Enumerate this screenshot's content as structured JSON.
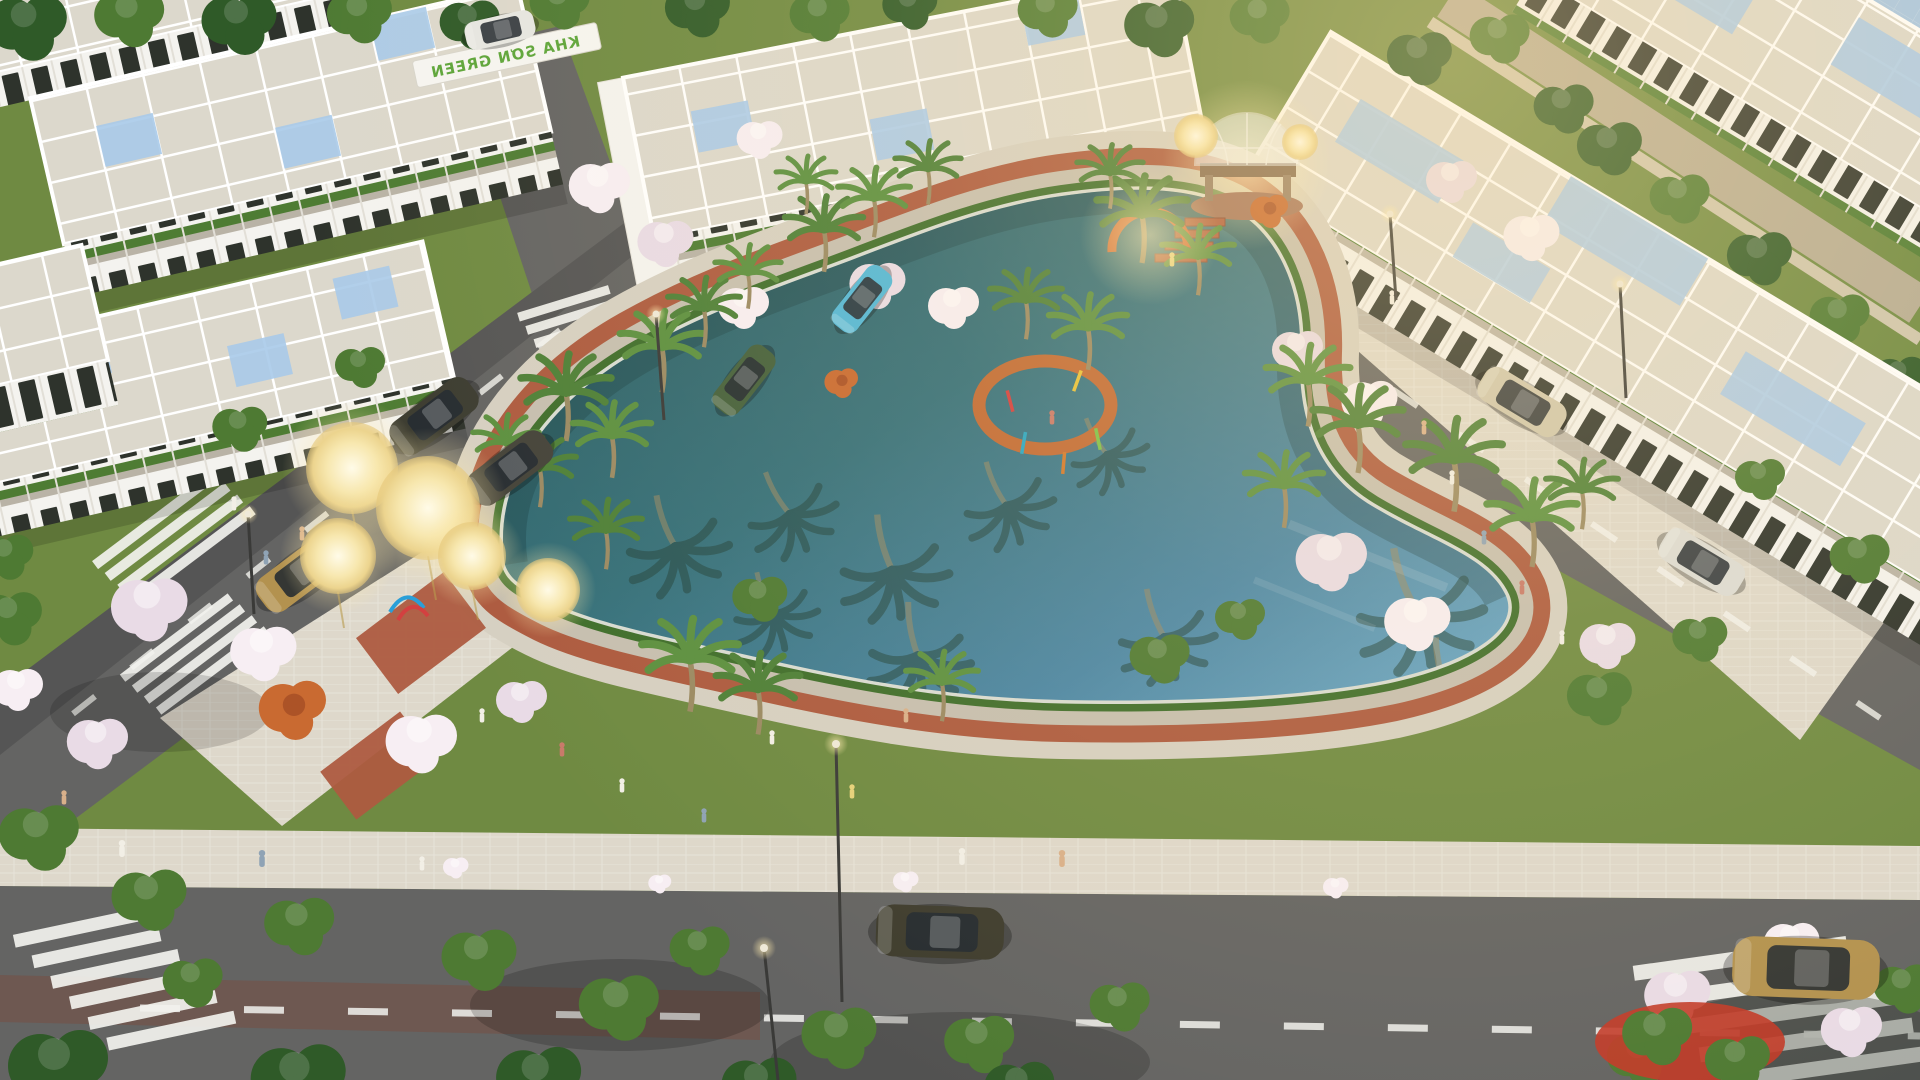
{
  "scene": {
    "type": "aerial-3d-architectural-render",
    "subject": "residential park with central lake, shophouse rows, promenade and roads",
    "gate_sign": {
      "text": "KHA SƠN GREEN",
      "color": "#5da53a"
    },
    "colors": {
      "lawn": "#6f8a42",
      "lawnLight": "#85a354",
      "hedge": "#3f6e2c",
      "lakeDeep": "#2a5a5e",
      "lakeMid": "#35707a",
      "lakeBright": "#63a0bf",
      "brick": "#ad5b40",
      "stone": "#c6bfb0",
      "rim": "#d8dcd3",
      "promenade": "#d6d0c2",
      "asphalt": "#646463",
      "roadline": "#f2f2ee",
      "sidewalk": "#ded8cb",
      "roof": "#dcd8cc",
      "glass": "#a9cae9",
      "wall": "#f4f3ef",
      "facadeDark": "#2e332c",
      "balcony": "#4e7c33",
      "palm": "#4e8038",
      "blossom": "#e9dbe6",
      "blossomLight": "#f7eef3",
      "treeGreen": "#4e7a33",
      "treeDark": "#2f5a28",
      "flame": "#c96a31",
      "glow": "#ffe9a8",
      "glowCore": "#fff7d8",
      "waterFar": "#a6c6e4",
      "wallFar": "#b6ac94",
      "carGold": "#b3924f",
      "carDark": "#3c3c31",
      "carRed": "#c23a28",
      "carCyan": "#52b7d7",
      "carGreen": "#44603c",
      "carBeige": "#cfc7ad",
      "carWhite": "#e6e6e2"
    },
    "inventory": {
      "lake": 1,
      "dome_gazebo": 1,
      "building_rows": 6,
      "glow_light_spheres": 5,
      "crosswalks": 5,
      "playground_rings": 2,
      "cars": [
        "gold sedan on left road",
        "dark suv on left road",
        "dark sedan on left road",
        "cyan hatchback on inner street",
        "green sedan on inner street",
        "white car at top street",
        "beige car parked on right road",
        "white car parked on right road",
        "dark olive sedan on bottom road",
        "gold sedan at bottom right",
        "red car under trees bottom right"
      ]
    }
  }
}
